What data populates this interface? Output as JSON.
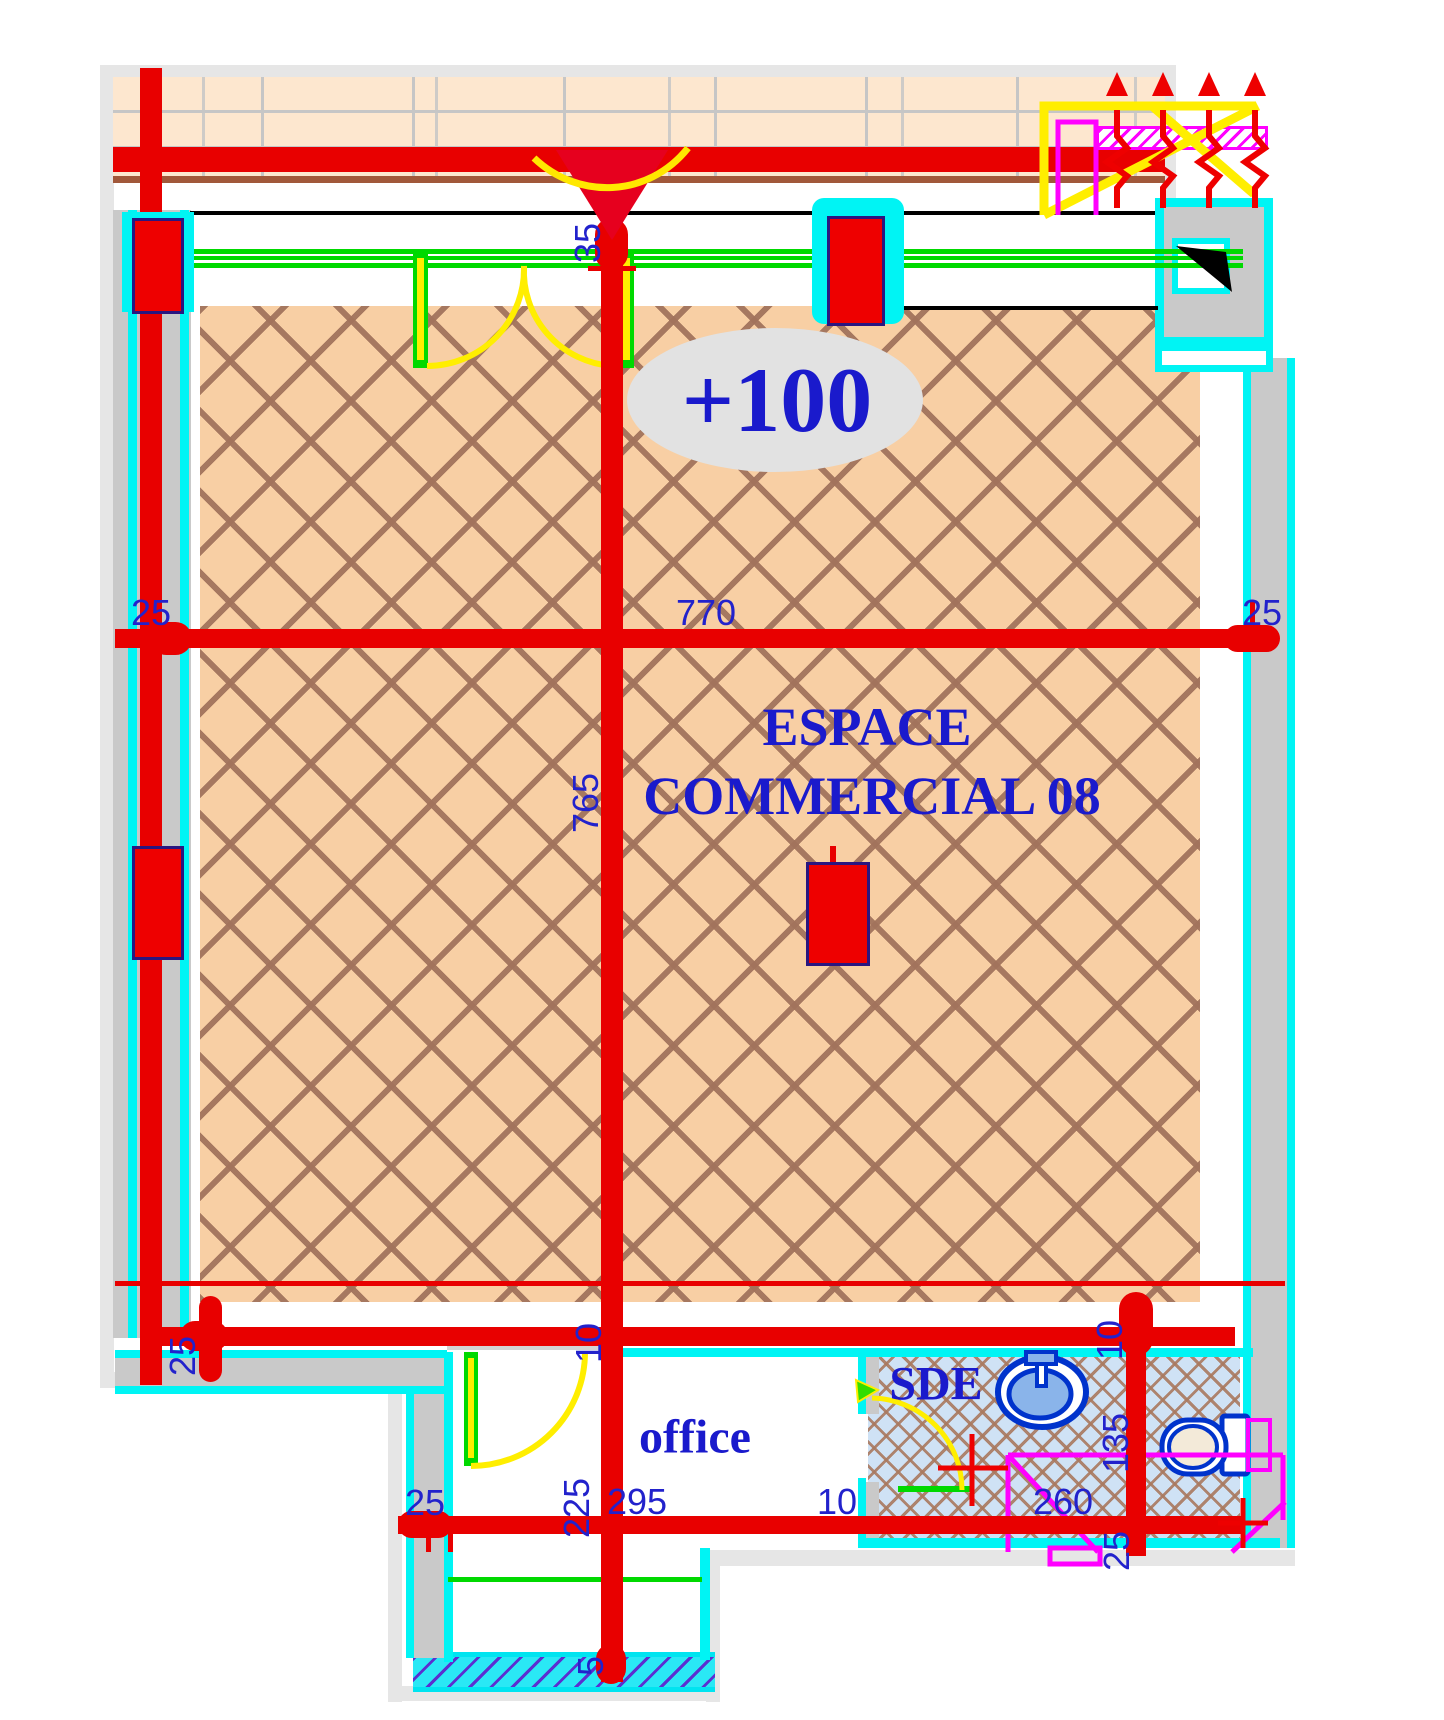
{
  "drawing": {
    "level_marker": "+100",
    "main_room_line1": "ESPACE",
    "main_room_line2": "COMMERCIAL 08",
    "office_label": "office",
    "sde_label": "SDE"
  },
  "dimensions": {
    "top_wall_thickness": "35",
    "mid_left_offset": "25",
    "main_width": "770",
    "mid_right_offset": "25",
    "main_height": "765",
    "lower_left_offset": "25",
    "lower_center_gap": "10",
    "lower_right_gap": "10",
    "sde_height": "135",
    "sde_small_offset": "25",
    "bottom_left_offset": "25",
    "office_depth": "225",
    "office_width": "295",
    "partition_gap": "10",
    "sde_width": "260",
    "tail_offset": "5"
  },
  "icons": {
    "sink": "sink-icon",
    "toilet": "toilet-icon",
    "shaft_flag": "shaft-flag-icon",
    "entrance_arrow": "entrance-arrow-icon"
  },
  "colors": {
    "accent_red": "#e80000",
    "wall_cyan": "#00ffff",
    "window_green": "#00d900",
    "door_yellow": "#ffee00",
    "annotation_magenta": "#ff00ff",
    "label_blue": "#1a1acc",
    "floor_tan": "#f8cfa4",
    "floor_sde_blue": "#cfe2f5"
  }
}
